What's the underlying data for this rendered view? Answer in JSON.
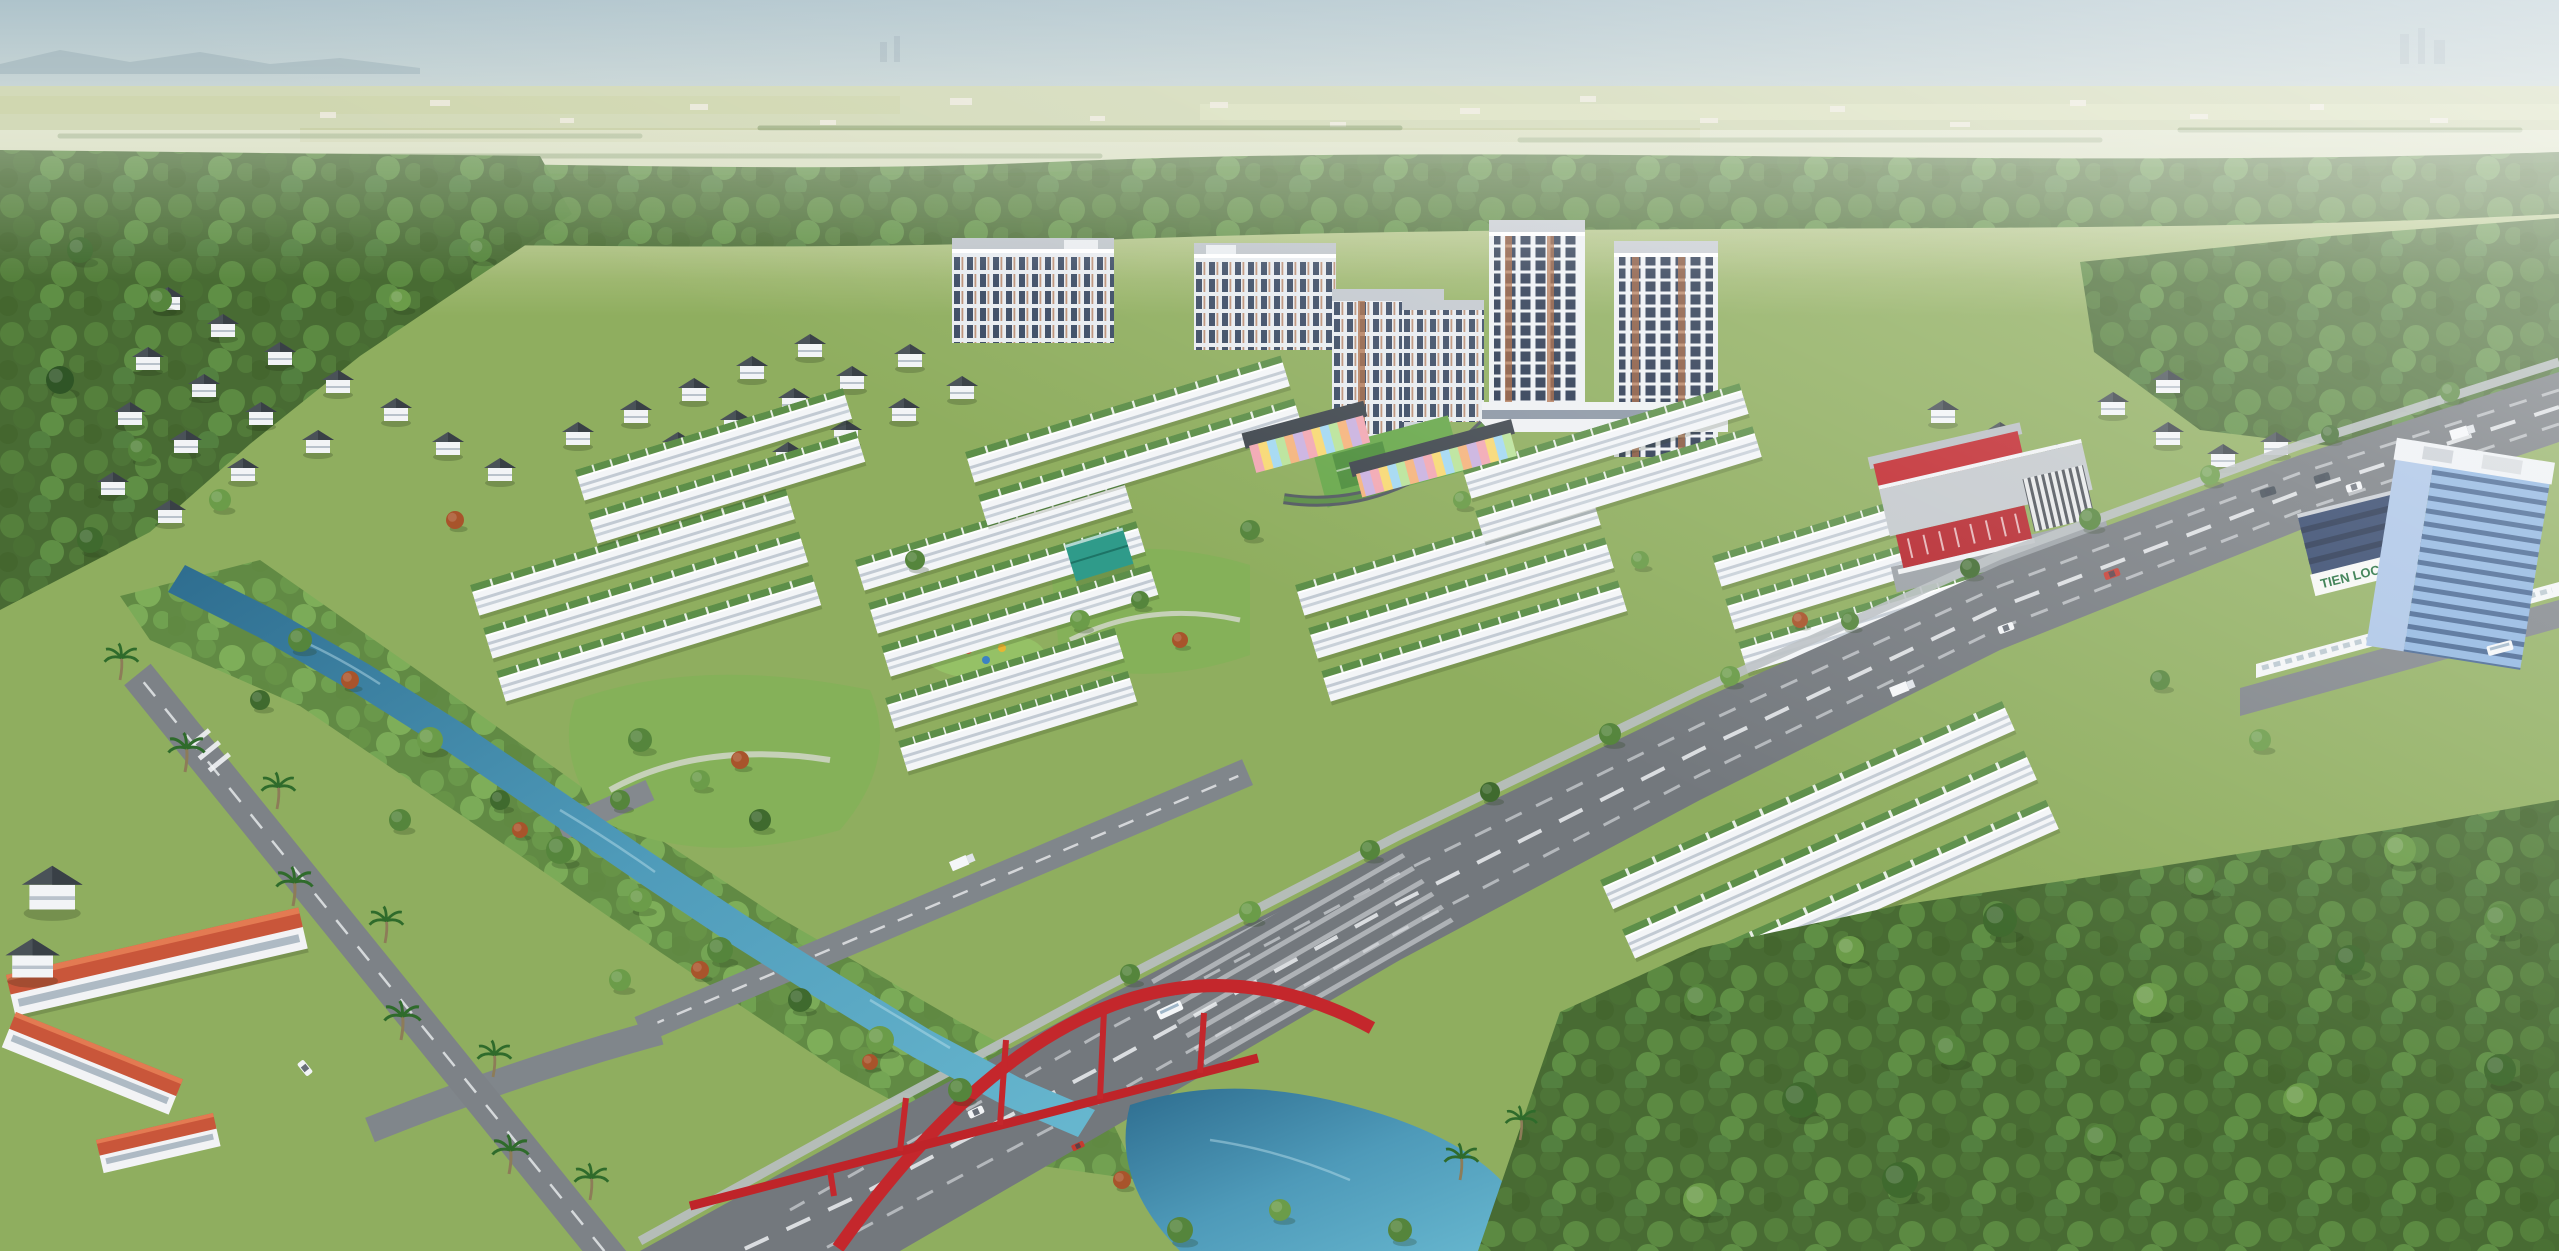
{
  "scene": {
    "type": "aerial-3d-architectural-render",
    "subject": "Bird's-eye rendering of a master-planned residential township: townhouse rows with green roofs, apartment high-rises, villas, kindergarten, commercial center, canal, pond and a red arch bridge over a boulevard",
    "signs": {
      "plaza_sign": "TIEN LOC PLAZA"
    },
    "counts": {
      "high_rise_towers": 2,
      "mid_rise_blocks": 4,
      "townhouse_blocks": 8
    },
    "landmarks": [
      {
        "name": "plaza-tower",
        "label": "Blue glass office tower"
      },
      {
        "name": "commercial-center",
        "label": "Red commercial center"
      },
      {
        "name": "kindergarten",
        "label": "Rainbow-striped kindergarten"
      },
      {
        "name": "red-arch-bridge",
        "label": "Red tied-arch bridge"
      },
      {
        "name": "canal",
        "label": "Landscaped canal and pond"
      },
      {
        "name": "school",
        "label": "Orange-roofed school"
      },
      {
        "name": "boulevard",
        "label": "Main boulevard with traffic"
      }
    ],
    "palette": {
      "sky": "#b2c5cd",
      "horizon_haze": "#e7ebe2",
      "distant_fields": "#d3dab9",
      "forest": "#486b33",
      "lawn": "#8fae5f",
      "park": "#85b159",
      "water": "#3a7da0",
      "road": "#73787d",
      "building_white": "#f3f5f7",
      "roof_green": "#5d8f49",
      "roof_dark": "#41484f",
      "roof_orange": "#c9563a",
      "accent_red": "#c0262c",
      "glass_blue": "#8db4e0",
      "glass_dark": "#2c3a52",
      "terracotta": "#a8643c",
      "sign_green": "#1c6b38"
    }
  }
}
